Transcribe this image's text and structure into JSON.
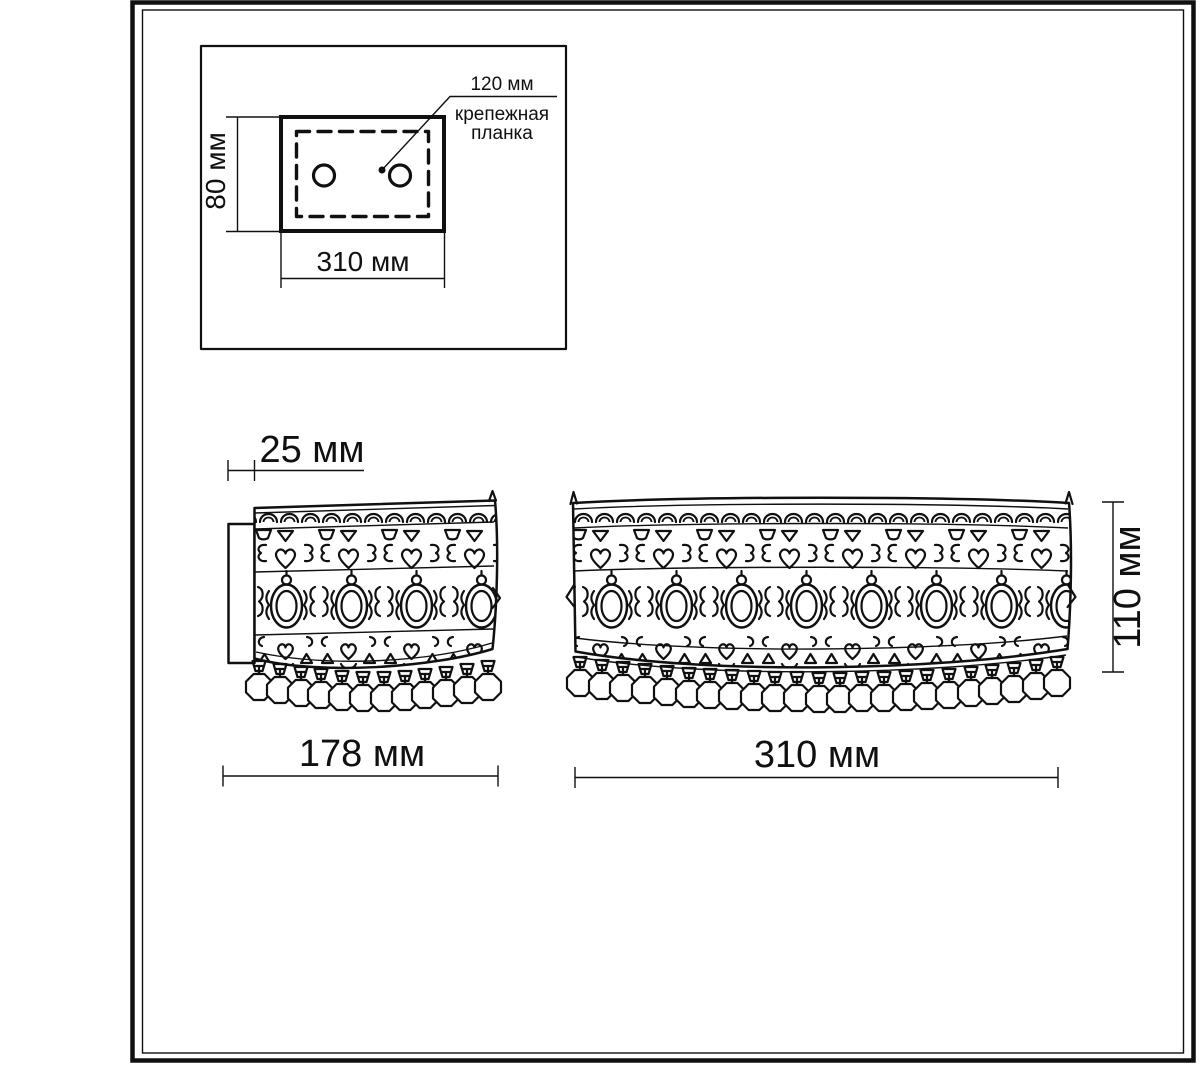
{
  "detail_view": {
    "height": "80 мм",
    "width": "310 мм",
    "callout": {
      "value": "120 мм",
      "line1": "крепежная",
      "line2": "планка"
    }
  },
  "side_view": {
    "depth": "25 мм",
    "width": "178 мм"
  },
  "front_view": {
    "width": "310 мм",
    "height": "110 мм"
  },
  "colors": {
    "ink": "#101010",
    "paper": "#ffffff"
  }
}
